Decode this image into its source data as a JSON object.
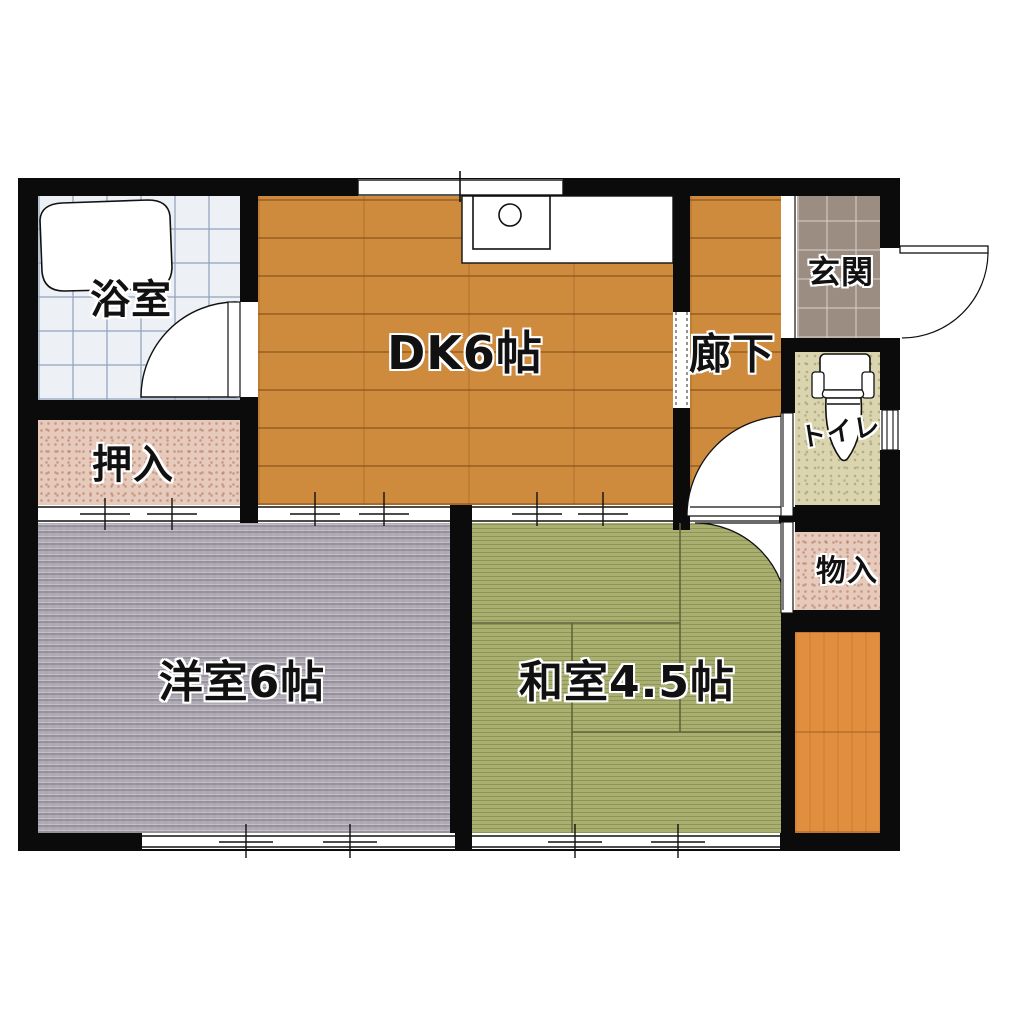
{
  "rooms": {
    "bathroom": {
      "label": "浴室"
    },
    "closet": {
      "label": "押入"
    },
    "dining_kitchen": {
      "label": "DK6帖"
    },
    "corridor": {
      "label": "廊下"
    },
    "entrance": {
      "label": "玄関"
    },
    "toilet": {
      "label": "トイレ"
    },
    "storage": {
      "label": "物入"
    },
    "western_room": {
      "label": "洋室6帖"
    },
    "japanese_room": {
      "label": "和室4.5帖"
    }
  },
  "colors": {
    "wall": "#0b0b0b",
    "wood_floor": "#ce8b3e",
    "wood_strip": "#e28e3f",
    "tatami_green": "#a9af71",
    "carpet_gray": "#b0acb6",
    "closet_pink": "#e6cbbc",
    "toilet_beige": "#dbd5af",
    "bath_tile": "#edf0f4",
    "entrance_tile": "#9c8d82",
    "background": "#ffffff"
  }
}
